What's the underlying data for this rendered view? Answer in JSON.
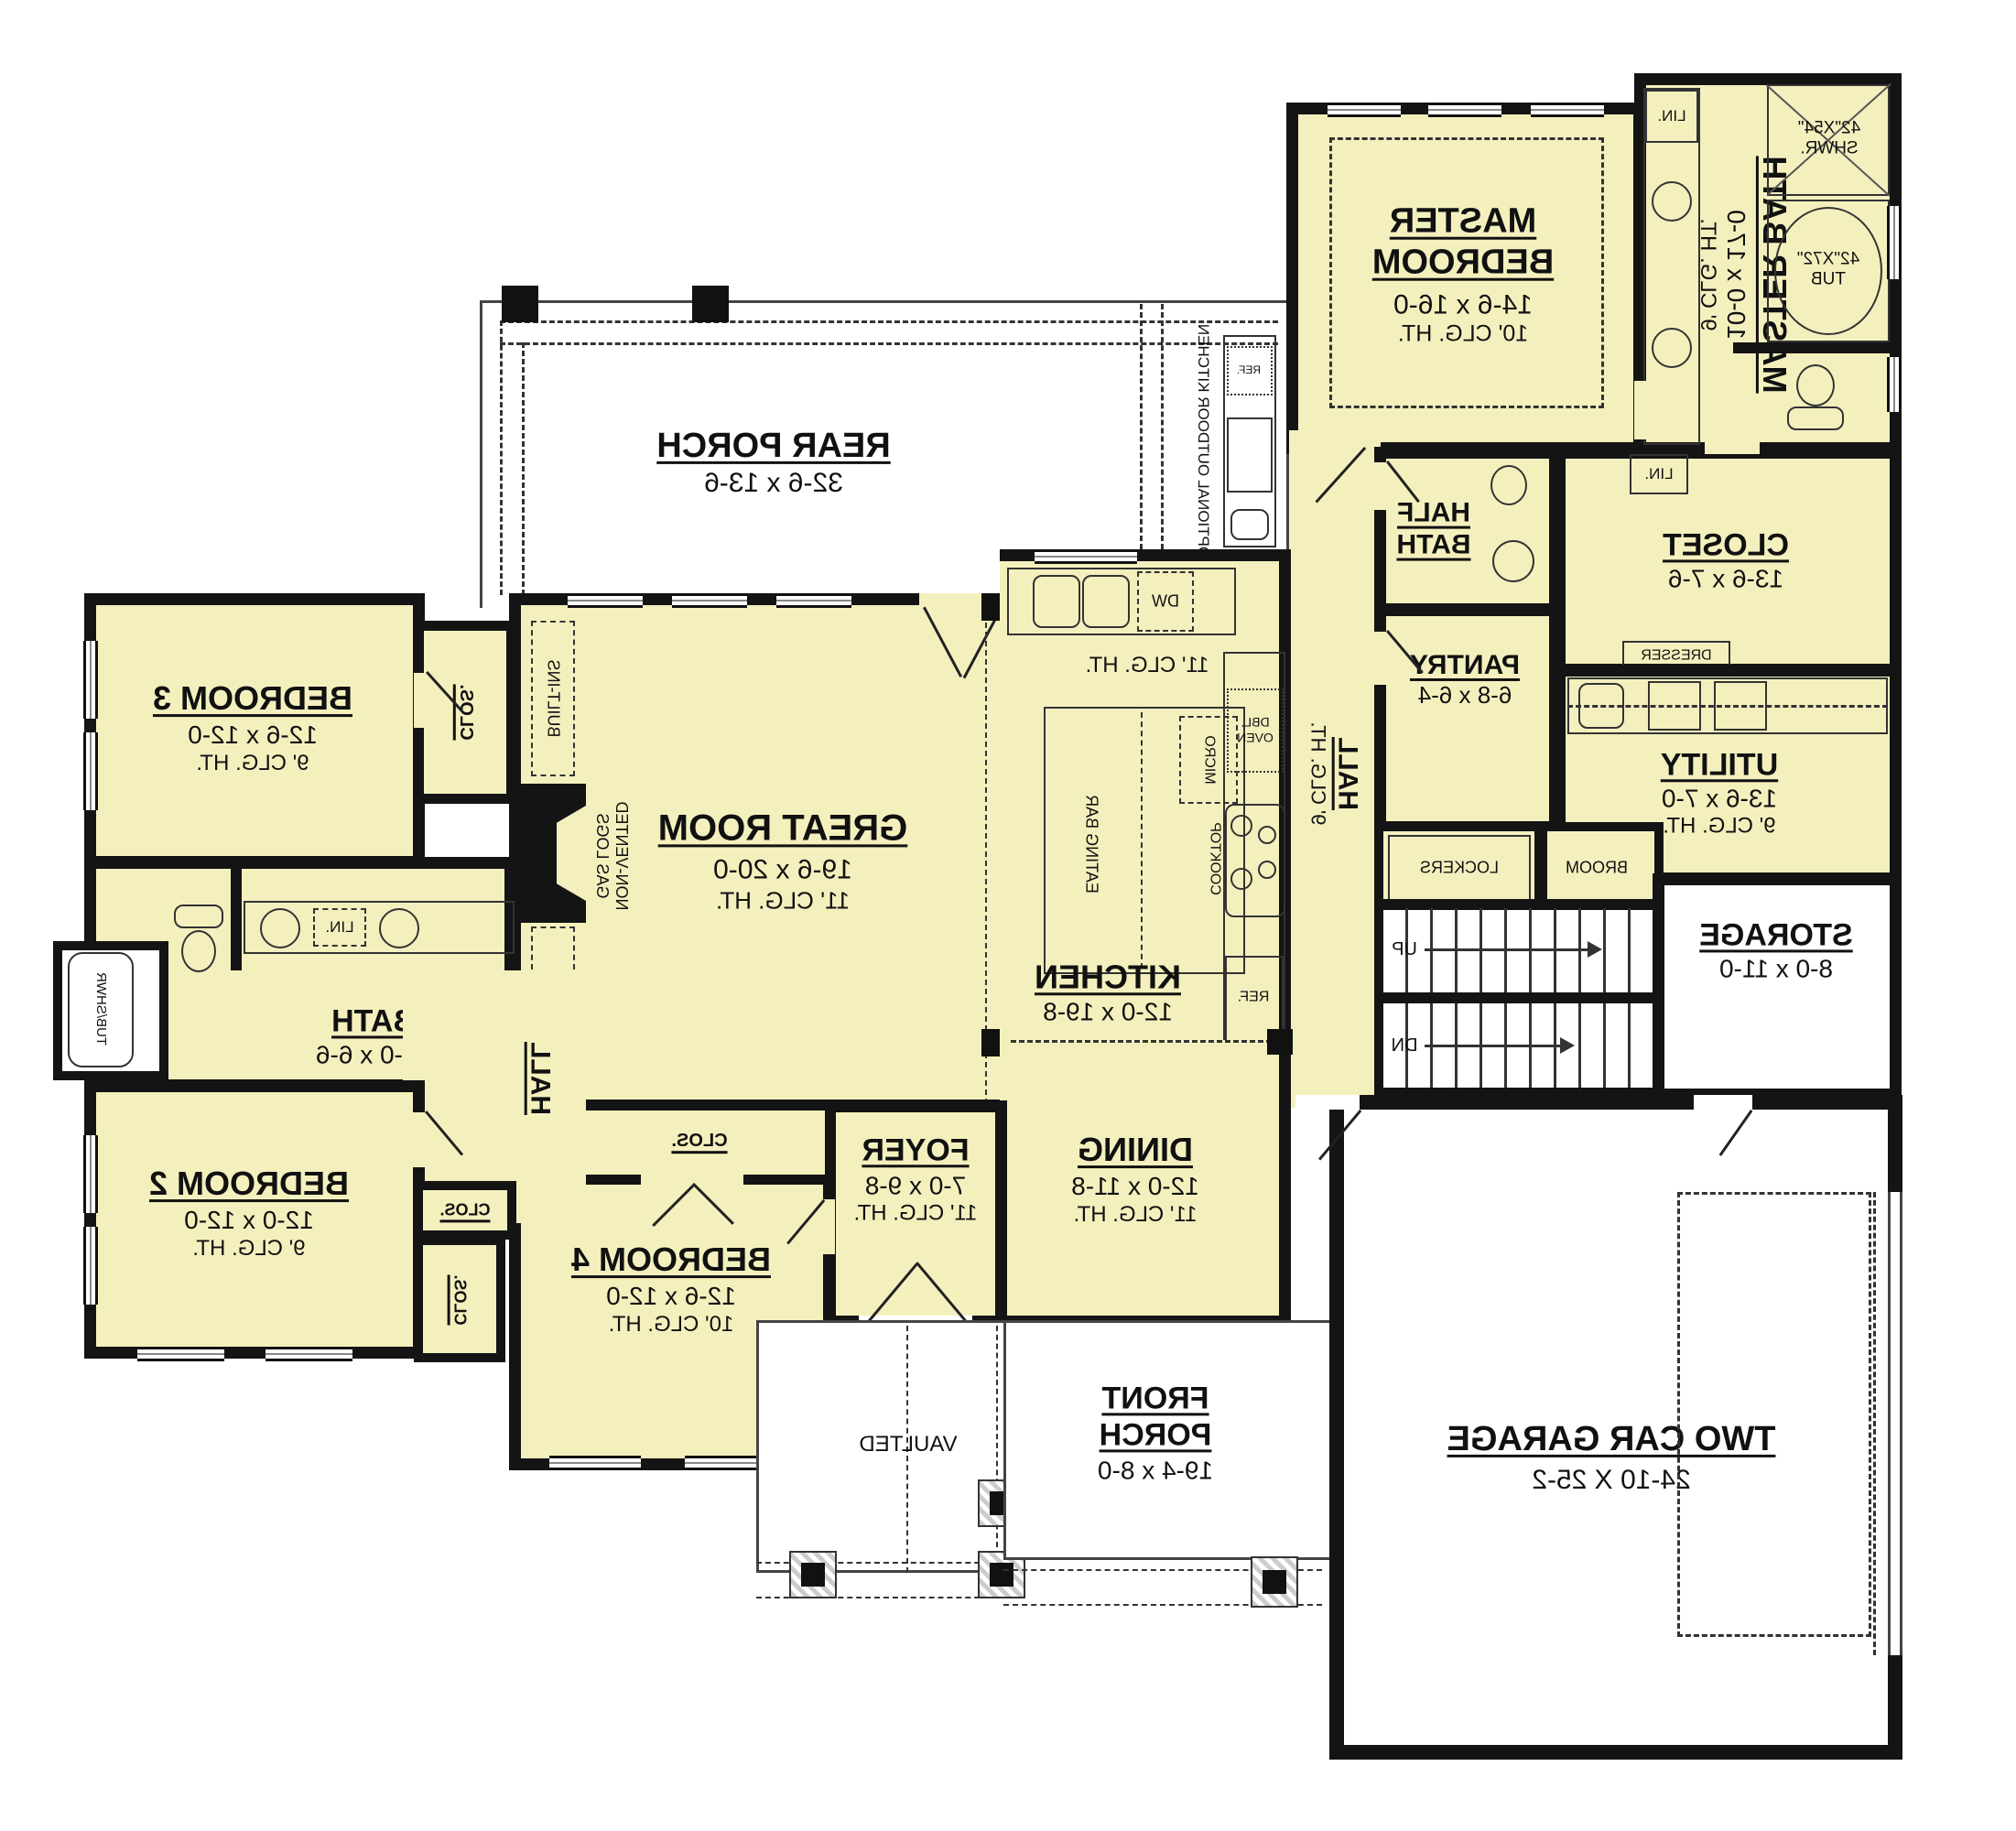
{
  "plan_title": "First Floor Plan (mirrored print)",
  "colors": {
    "room_fill": "#F4F0BE",
    "wall": "#141414",
    "paper": "#FFFFFF"
  },
  "labels": {
    "rear_porch_name": "REAR PORCH",
    "rear_porch_dims": "32-6 x 13-6",
    "master_1": "MASTER",
    "master_2": "BEDROOM",
    "master_dims": "14-6 x 16-0",
    "clg10": "10' CLG. HT.",
    "clg9": "9' CLG. HT.",
    "clg11": "11' CLG. HT.",
    "master_bath_name": "MASTER BATH",
    "master_bath_dims": "10-0 x 17-0",
    "shwr_1": "42\"X54\"",
    "shwr_2": "SHWR.",
    "tub_1": "42\"X72\"",
    "tub_2": "TUB",
    "lin": "LIN.",
    "closet_name": "CLOSET",
    "closet_dims": "13-6 x 7-6",
    "dresser": "DRESSER",
    "half_1": "HALF",
    "half_2": "BATH",
    "pantry_name": "PANTRY",
    "pantry_dims": "6-8 x 6-4",
    "utility_name": "UTILITY",
    "utility_dims": "13-6 x 7-0",
    "hall": "HALL",
    "lockers": "LOCKERS",
    "broom": "BROOM",
    "up": "UP",
    "dn": "DN",
    "storage_name": "STORAGE",
    "storage_dims": "8-0 x 11-0",
    "great_name": "GREAT ROOM",
    "great_dims": "19-6 x 20-0",
    "built_ins": "BUILT-INS",
    "gas_1": "NON-VENTED",
    "gas_2": "GAS LOGS",
    "kitchen_name": "KITCHEN",
    "kitchen_dims": "12-0 x 19-8",
    "eating_bar": "EATING BAR",
    "micro": "MICRO",
    "dbl_1": "DBL.",
    "dbl_2": "OVEN",
    "cooktop": "COOKTOP",
    "ref": "REF.",
    "dw": "DW",
    "outdoor_kitchen": "OPTIONAL OUTDOOR KITCHEN",
    "dining_name": "DINING",
    "dining_dims": "12-0 x 11-8",
    "foyer_name": "FOYER",
    "foyer_dims": "7-0 x 9-8",
    "bed2_name": "BEDROOM 2",
    "bed2_dims": "12-0 x 12-0",
    "bed3_name": "BEDROOM 3",
    "bed3_dims": "12-6 x 12-0",
    "bed4_name": "BEDROOM 4",
    "bed4_dims": "12-6 x 12-0",
    "bath_name": "BATH",
    "bath_dims": "14-0 x 6-6",
    "tub_shwr": "TUB/SHWR",
    "clos": "CLOS.",
    "front_1": "FRONT",
    "front_2": "PORCH",
    "front_dims": "19-4 x 8-0",
    "vaulted": "VAULTED",
    "garage_name": "TWO CAR GARAGE",
    "garage_dims": "24-10 X 25-2"
  }
}
